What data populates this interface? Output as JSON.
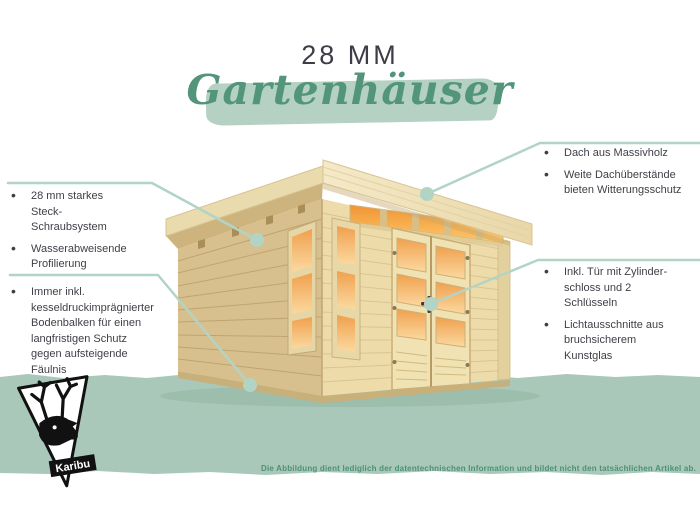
{
  "page": {
    "title_top": "28 MM",
    "title_script": "Gartenhäuser",
    "disclaimer": "Die Abbildung dient lediglich der datentechnischen Information und bildet nicht den tatsächlichen Artikel ab.",
    "brand": "Karibu"
  },
  "callouts": {
    "left_top": {
      "items": [
        "28 mm starkes Steck-Schraubsystem",
        "Wasserabweisende Profilierung"
      ]
    },
    "left_bottom": {
      "items": [
        "Immer inkl. kesseldruckim­prägnierter Bodenbalken für einen langfristigen Schutz gegen aufsteigende Fäulnis"
      ]
    },
    "right_top": {
      "items": [
        "Dach aus Massivholz",
        "Weite Dachüberstände bieten Witterungsschutz"
      ]
    },
    "right_middle": {
      "items": [
        "Inkl. Tür mit Zylinder­schloss und 2 Schlüsseln",
        "Lichtausschnitte aus bruchsicherem Kunstglas"
      ]
    }
  },
  "icons": {
    "logo": "karibu-deer-logo"
  },
  "colors": {
    "band_green": "#a9c8b9",
    "brush_green": "#b4d1c3",
    "script_green": "#53957a",
    "disclaimer_green": "#4d9175",
    "callout_line": "#b2d4c5",
    "text_dark": "#3f3f47",
    "wood_light": "#eddcaa",
    "wood_side": "#d7c08e",
    "glass_orange": "#f2a452"
  }
}
